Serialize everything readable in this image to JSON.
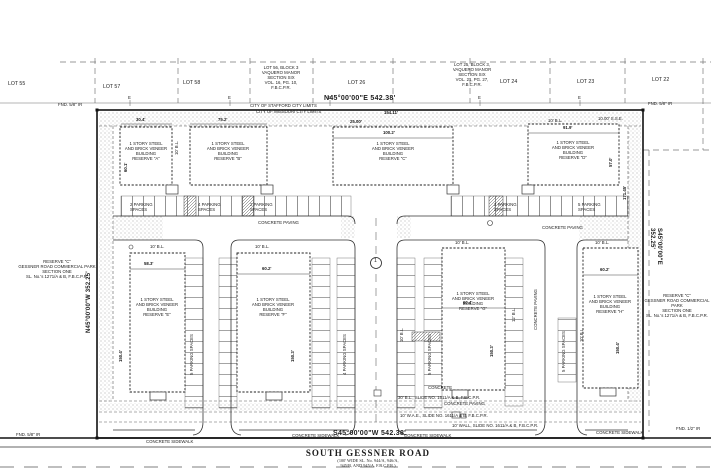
{
  "plan": {
    "bearings": {
      "north": "N45°00'00\"E  542.38'",
      "south": "S45°00'00\"W  542.38'",
      "west": "N45°00'00\"W  352.25'",
      "east": "S45°00'00\"E  352.25'"
    },
    "monuments": {
      "nw": "FND. 5/8\" IR",
      "ne": "FND. 5/8\" IR",
      "sw": "FND. 5/8\" IR",
      "se": "FND. 1/2\" IR"
    },
    "city_limits_stafford": "CITY OF STAFFORD CITY LIMITS",
    "city_limits_missouri": "CITY OF MISSOURI CITY LIMITS",
    "electric_marker": "E",
    "keynote": "1",
    "lots": [
      {
        "label": "LOT 55"
      },
      {
        "label": "LOT 57"
      },
      {
        "label": "LOT 58"
      },
      {
        "label": "LOT 56, BLOCK 3\nVAQUERO MANOR\nSECTION SIX\nVOL. 16, PG. 10,\nF.B.C.P.R."
      },
      {
        "label": "LOT 26"
      },
      {
        "label": "LOT 25, BLOCK 3,\nVAQUERO MANOR\nSECTION SIX\nVOL. 21, PG. 27,\nF.B.C.P.R."
      },
      {
        "label": "LOT 24"
      },
      {
        "label": "LOT 23"
      },
      {
        "label": "LOT 22"
      }
    ],
    "reserves": {
      "west": "RESERVE \"C\"\nGESSNER ROAD COMMERCIAL PARK\nSECTION ONE\nSL. No.'s 1271/A & B, F.B.C.P.R.",
      "east": "RESERVE \"C\"\nGESSNER ROAD COMMERCIAL PARK\nSECTION ONE\nSL. No.'s 1271/A & B, F.B.C.P.R."
    },
    "buildings": [
      {
        "label": "1 STORY STEEL\nAND BRICK VENEER\nBUILDING\nRESERVE \"A\"",
        "width": "30.4'",
        "depth": "60.1'"
      },
      {
        "label": "1 STORY STEEL\nAND BRICK VENEER\nBUILDING\nRESERVE \"B\"",
        "width": "75.2'"
      },
      {
        "label": "1 STORY STEEL\nAND BRICK VENEER\nBUILDING\nRESERVE \"C\"",
        "width": "100.2'"
      },
      {
        "label": "1 STORY STEEL\nAND BRICK VENEER\nBUILDING\nRESERVE \"D\"",
        "width": "91.9'",
        "depth": "57.0'"
      },
      {
        "label": "1 STORY STEEL\nAND BRICK VENEER\nBUILDING\nRESERVE \"E\"",
        "width": "58.3'",
        "depth": "150.4'"
      },
      {
        "label": "1 STORY STEEL\nAND BRICK VENEER\nBUILDING\nRESERVE \"F\"",
        "width": "60.2'",
        "depth": "150.3'"
      },
      {
        "label": "1 STORY STEEL\nAND BRICK VENEER\nBUILDING\nRESERVE \"G\"",
        "width": "60.4'",
        "depth": "150.3'"
      },
      {
        "label": "1 STORY STEEL\nAND BRICK VENEER\nBUILDING\nRESERVE \"H\"",
        "width": "60.2'",
        "depth": "150.4'"
      }
    ],
    "easements": {
      "bl30": "30' B.L., SLIDE NO. 1611/A & B, F.B.C.P.R.",
      "wae10": "10' W.A.E., SLIDE NO. 1611/A & B, F.B.C.P.R.",
      "wall10": "10' WALL, SLIDE NO. 1611/A & B, F.B.C.P.R.",
      "bl10": "10' B.L.",
      "bl12": "12' B.L.",
      "sse10": "10.00' S.S.E."
    },
    "surfaces": {
      "paving": "CONCRETE PAVING",
      "sidewalk": "CONCRETE SIDEWALK",
      "concrete": "CONCRETE"
    },
    "parking": {
      "p2": "2 PARKING SPACES",
      "p4": "4 PARKING SPACES",
      "p5": "5 PARKING SPACES"
    },
    "dims": {
      "d1": "154.11'",
      "d2": "25.00'",
      "d3": "171.45'"
    },
    "road": {
      "name": "SOUTH GESSNER ROAD",
      "detail": "(100' WIDE SL. No. 944/A, 946/A,\n945/B, AND 945/A, F.B.C.P.R.)"
    }
  }
}
